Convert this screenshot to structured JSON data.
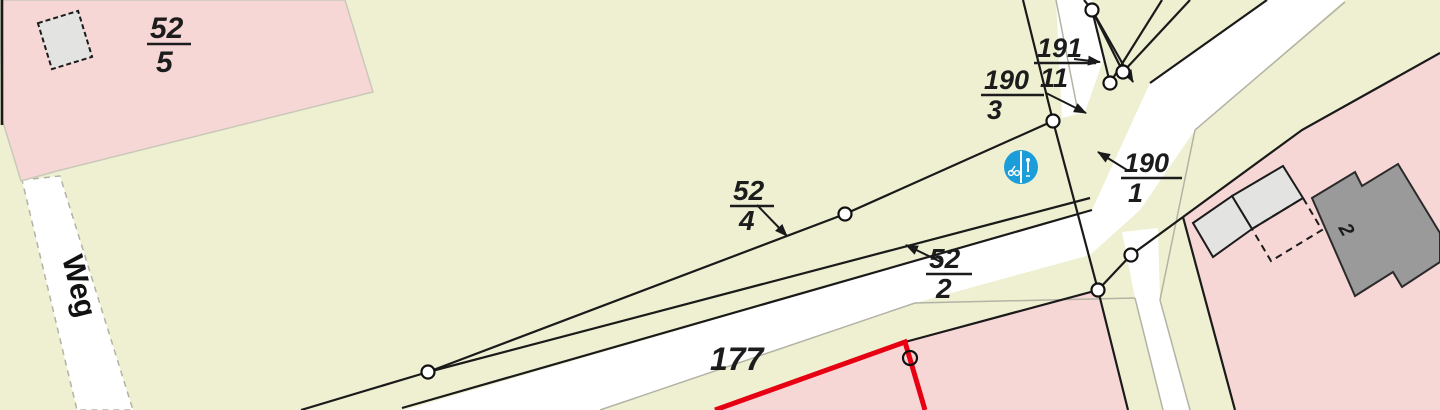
{
  "map": {
    "title": "cadastral-map-view",
    "labels": {
      "parcel_52_5": {
        "numerator": "52",
        "denominator": "5"
      },
      "parcel_52_4": {
        "numerator": "52",
        "denominator": "4"
      },
      "parcel_52_2": {
        "numerator": "52",
        "denominator": "2"
      },
      "parcel_190_3": {
        "numerator": "190",
        "denominator": "3"
      },
      "parcel_191_11": {
        "numerator": "191",
        "denominator": "11"
      },
      "parcel_190_1": {
        "numerator": "190",
        "denominator": "1"
      },
      "parcel_177": {
        "text": "177"
      },
      "road_name": {
        "text": "Weg"
      },
      "building_number": {
        "text": "2"
      }
    },
    "icons": {
      "traffic_sign": {
        "name": "pedestrian-bike-sign-icon",
        "color": "#1b9dd9"
      }
    },
    "colors": {
      "background": "#eef0d1",
      "road": "#ffffff",
      "parcel_pink": "#f7d6d6",
      "building_light": "#e3e3e1",
      "building_dark": "#9a9a9a",
      "boundary_black": "#1a1a1a",
      "boundary_red": "#e60012",
      "minor_line": "#b3b3a5",
      "sign_blue": "#1b9dd9"
    }
  }
}
